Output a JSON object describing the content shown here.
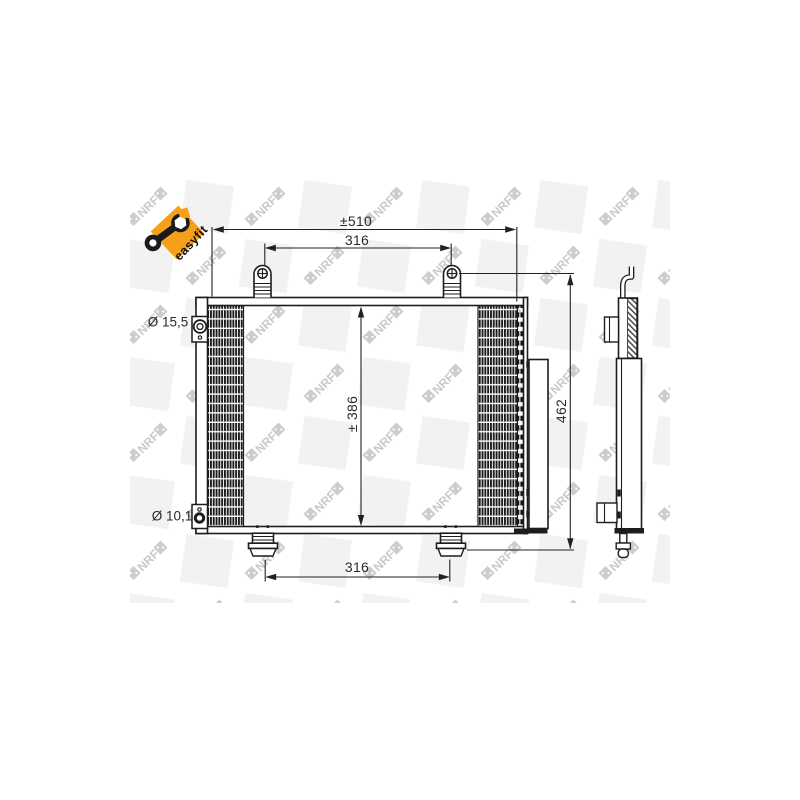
{
  "brand": {
    "watermark_text": "NRF",
    "badge": {
      "label": "easyfit",
      "bg_color": "#F6A01A",
      "text_color": "#101010"
    }
  },
  "drawing": {
    "dimensions": {
      "overall_width": "±510",
      "top_mount_spacing": "316",
      "core_height": "± 386",
      "overall_height": "462",
      "bottom_mount_spacing": "316",
      "port_top_diameter": "Ø 15,5",
      "port_bottom_diameter": "Ø 10,1"
    },
    "colors": {
      "line": "#1d1d1b",
      "watermark_mark": "#cdcdcd",
      "watermark_tile": "#f2f2f2"
    }
  }
}
